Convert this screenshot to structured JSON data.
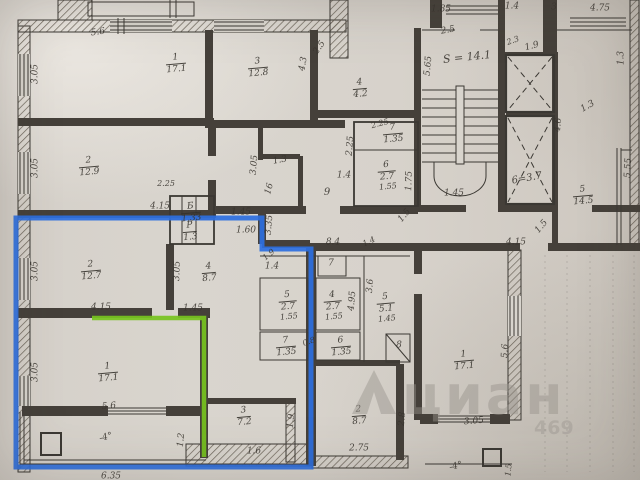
{
  "watermark": {
    "logo": "cian-house-logo",
    "text": "циан",
    "digits": "469",
    "color": "#97928b"
  },
  "highlights": {
    "blue": "#2d6fe1",
    "green": "#77c31f"
  },
  "ink": "#38342e",
  "stairwell_area_label": "S = 14.1",
  "elevator_label": "6=3.7",
  "rooms": [
    {
      "n": "1",
      "a": "17.1",
      "x": 176,
      "y": 64
    },
    {
      "n": "3",
      "a": "12.8",
      "x": 258,
      "y": 68
    },
    {
      "n": "4",
      "a": "4.2",
      "x": 360,
      "y": 89
    },
    {
      "n": "2",
      "a": "12.9",
      "x": 89,
      "y": 167
    },
    {
      "n": "2",
      "a": "12.7",
      "x": 91,
      "y": 271
    },
    {
      "n": "4",
      "a": "8.7",
      "x": 209,
      "y": 273
    },
    {
      "n": "1",
      "a": "17.1",
      "x": 108,
      "y": 373
    },
    {
      "n": "3",
      "a": "7.2",
      "x": 244,
      "y": 417
    },
    {
      "n": "2",
      "a": "8.7",
      "x": 359,
      "y": 416
    },
    {
      "n": "1",
      "a": "17.1",
      "x": 464,
      "y": 361
    },
    {
      "n": "5",
      "a": "14.5",
      "x": 583,
      "y": 196
    },
    {
      "n": "Б",
      "a": "1.33",
      "x": 191,
      "y": 213
    },
    {
      "n": "Р",
      "a": "1.3",
      "x": 190,
      "y": 232
    },
    {
      "n": "7",
      "a": "1.35",
      "x": 393,
      "y": 134
    },
    {
      "n": "6",
      "a": "2.7",
      "d": "1.55",
      "x": 387,
      "y": 176
    },
    {
      "n": "5",
      "a": "2.7",
      "d": "1.55",
      "x": 288,
      "y": 306
    },
    {
      "n": "4",
      "a": "2.7",
      "d": "1.55",
      "x": 333,
      "y": 306
    },
    {
      "n": "5",
      "a": "5.1",
      "d": "1.45",
      "x": 386,
      "y": 308
    },
    {
      "n": "7",
      "a": "1.35",
      "x": 286,
      "y": 347
    },
    {
      "n": "6",
      "a": "1.35",
      "x": 341,
      "y": 347
    }
  ],
  "labels": [
    {
      "t": "5.6",
      "x": 98,
      "y": 33,
      "r": -8,
      "s": 9
    },
    {
      "t": "3.05",
      "x": 36,
      "y": 74,
      "r": -90,
      "s": 9
    },
    {
      "t": "4.3",
      "x": 304,
      "y": 64,
      "r": -80,
      "s": 9
    },
    {
      "t": "2.5",
      "x": 320,
      "y": 48,
      "r": -55,
      "s": 9
    },
    {
      "t": "1.85",
      "x": 441,
      "y": 10,
      "r": 0,
      "s": 9
    },
    {
      "t": "1.4",
      "x": 512,
      "y": 7,
      "r": 0,
      "s": 9
    },
    {
      "t": "3",
      "x": 554,
      "y": 8,
      "r": 0,
      "s": 9
    },
    {
      "t": "4.75",
      "x": 600,
      "y": 9,
      "r": 0,
      "s": 9
    },
    {
      "t": "2.5",
      "x": 448,
      "y": 31,
      "r": -10,
      "s": 9
    },
    {
      "t": "S = 14.1",
      "x": 467,
      "y": 57,
      "r": -6,
      "s": 11
    },
    {
      "t": "5.65",
      "x": 429,
      "y": 66,
      "r": -85,
      "s": 9
    },
    {
      "t": "2.3",
      "x": 513,
      "y": 41,
      "r": -20,
      "s": 8
    },
    {
      "t": "1.9",
      "x": 532,
      "y": 47,
      "r": -15,
      "s": 9
    },
    {
      "t": "1.3",
      "x": 622,
      "y": 58,
      "r": -90,
      "s": 9
    },
    {
      "t": "1.3",
      "x": 588,
      "y": 107,
      "r": -30,
      "s": 9
    },
    {
      "t": "4.6",
      "x": 559,
      "y": 125,
      "r": -85,
      "s": 9
    },
    {
      "t": "6=3.7",
      "x": 527,
      "y": 179,
      "r": -10,
      "s": 10
    },
    {
      "t": "5.55",
      "x": 629,
      "y": 168,
      "r": -87,
      "s": 9
    },
    {
      "t": "1.45",
      "x": 454,
      "y": 194,
      "r": 0,
      "s": 9
    },
    {
      "t": "1.5",
      "x": 405,
      "y": 216,
      "r": -50,
      "s": 9
    },
    {
      "t": "1.5",
      "x": 542,
      "y": 227,
      "r": -50,
      "s": 9
    },
    {
      "t": "4.15",
      "x": 516,
      "y": 243,
      "r": 0,
      "s": 9
    },
    {
      "t": "8.4",
      "x": 333,
      "y": 243,
      "r": 0,
      "s": 9
    },
    {
      "t": "1.4",
      "x": 369,
      "y": 242,
      "r": -25,
      "s": 8
    },
    {
      "t": "2.25",
      "x": 380,
      "y": 124,
      "r": -15,
      "s": 8
    },
    {
      "t": "2.25",
      "x": 351,
      "y": 146,
      "r": -85,
      "s": 9
    },
    {
      "t": "1.4",
      "x": 344,
      "y": 176,
      "r": 0,
      "s": 9
    },
    {
      "t": "1.75",
      "x": 410,
      "y": 181,
      "r": -88,
      "s": 9
    },
    {
      "t": "1.3",
      "x": 280,
      "y": 161,
      "r": -10,
      "s": 9
    },
    {
      "t": "16",
      "x": 270,
      "y": 189,
      "r": -75,
      "s": 9
    },
    {
      "t": "9",
      "x": 327,
      "y": 193,
      "r": 0,
      "s": 10
    },
    {
      "t": "3.05",
      "x": 255,
      "y": 165,
      "r": -85,
      "s": 9
    },
    {
      "t": "2.25",
      "x": 166,
      "y": 184,
      "r": 0,
      "s": 8
    },
    {
      "t": "1.45",
      "x": 241,
      "y": 213,
      "r": 0,
      "s": 9
    },
    {
      "t": "1.60",
      "x": 246,
      "y": 231,
      "r": 0,
      "s": 9
    },
    {
      "t": "3.35",
      "x": 270,
      "y": 225,
      "r": -85,
      "s": 9
    },
    {
      "t": "4.15",
      "x": 160,
      "y": 207,
      "r": 0,
      "s": 9
    },
    {
      "t": "3.05",
      "x": 36,
      "y": 168,
      "r": -90,
      "s": 9
    },
    {
      "t": "3.05",
      "x": 36,
      "y": 271,
      "r": -90,
      "s": 9
    },
    {
      "t": "3.05",
      "x": 178,
      "y": 271,
      "r": -88,
      "s": 9
    },
    {
      "t": "4.15",
      "x": 101,
      "y": 308,
      "r": 0,
      "s": 9
    },
    {
      "t": "1.45",
      "x": 193,
      "y": 309,
      "r": 0,
      "s": 9
    },
    {
      "t": "3.05",
      "x": 36,
      "y": 372,
      "r": -90,
      "s": 9
    },
    {
      "t": "5.6",
      "x": 109,
      "y": 407,
      "r": -5,
      "s": 9
    },
    {
      "t": "-4°",
      "x": 106,
      "y": 438,
      "r": -15,
      "s": 9
    },
    {
      "t": "1.2",
      "x": 182,
      "y": 440,
      "r": -85,
      "s": 9
    },
    {
      "t": "6.35",
      "x": 111,
      "y": 477,
      "r": 0,
      "s": 9
    },
    {
      "t": "1.6",
      "x": 254,
      "y": 452,
      "r": 0,
      "s": 9
    },
    {
      "t": "1.9",
      "x": 292,
      "y": 421,
      "r": -85,
      "s": 9
    },
    {
      "t": "1.9",
      "x": 269,
      "y": 255,
      "r": -40,
      "s": 8
    },
    {
      "t": "1.4",
      "x": 272,
      "y": 267,
      "r": 0,
      "s": 9
    },
    {
      "t": "7",
      "x": 331,
      "y": 264,
      "r": 0,
      "s": 9
    },
    {
      "t": "8",
      "x": 399,
      "y": 346,
      "r": 0,
      "s": 9
    },
    {
      "t": "0.8",
      "x": 309,
      "y": 342,
      "r": -20,
      "s": 8
    },
    {
      "t": "4.95",
      "x": 353,
      "y": 301,
      "r": -85,
      "s": 9
    },
    {
      "t": "3.6",
      "x": 371,
      "y": 286,
      "r": -85,
      "s": 9
    },
    {
      "t": "2.75",
      "x": 359,
      "y": 449,
      "r": 0,
      "s": 9
    },
    {
      "t": "2.8",
      "x": 403,
      "y": 419,
      "r": -85,
      "s": 9
    },
    {
      "t": "5.6",
      "x": 506,
      "y": 351,
      "r": -87,
      "s": 9
    },
    {
      "t": "3.05",
      "x": 474,
      "y": 422,
      "r": -5,
      "s": 9
    },
    {
      "t": "1.5",
      "x": 509,
      "y": 470,
      "r": -85,
      "s": 8
    },
    {
      "t": "-4°",
      "x": 456,
      "y": 467,
      "r": -15,
      "s": 9
    }
  ]
}
